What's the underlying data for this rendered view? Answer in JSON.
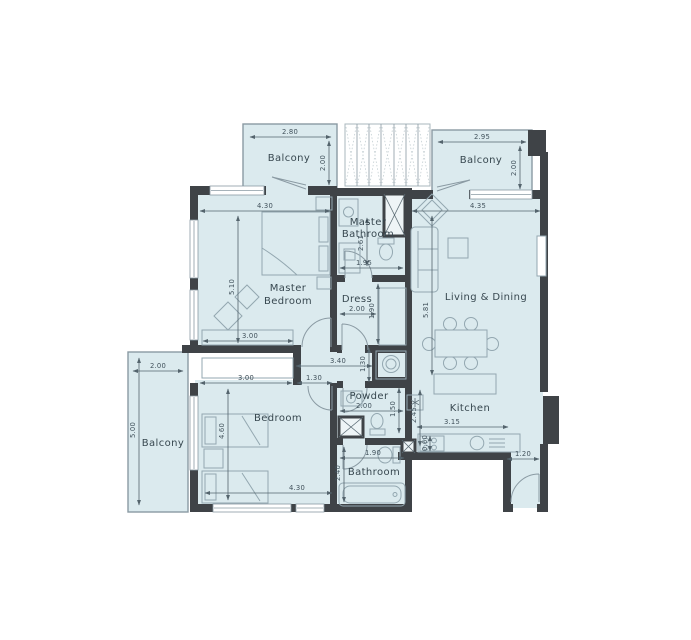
{
  "plan_title": "Apartment Floor Plan",
  "colors": {
    "floor": "#dbeaee",
    "wall": "#3f4347",
    "furniture_line": "#93a7b0",
    "dimension_line": "#54646d",
    "label_text": "#37474f",
    "background": "#ffffff"
  },
  "rooms": {
    "balcony_top_left": {
      "label": "Balcony"
    },
    "balcony_top_right": {
      "label": "Balcony"
    },
    "balcony_left": {
      "label": "Balcony"
    },
    "master_bedroom": {
      "label_line1": "Master",
      "label_line2": "Bedroom"
    },
    "master_bathroom": {
      "label_line1": "Master",
      "label_line2": "Bathroom"
    },
    "dress": {
      "label": "Dress"
    },
    "living_dining": {
      "label": "Living & Dining"
    },
    "bedroom": {
      "label": "Bedroom"
    },
    "powder": {
      "label": "Powder"
    },
    "kitchen": {
      "label": "Kitchen"
    },
    "bathroom": {
      "label": "Bathroom"
    }
  },
  "dimensions": {
    "balcony_top_left_width": "2.80",
    "balcony_top_left_depth": "2.00",
    "balcony_top_right_width": "2.95",
    "balcony_top_right_depth": "2.00",
    "master_bedroom_width": "4.30",
    "master_bedroom_length": "5.10",
    "master_bedroom_wardrobe": "3.00",
    "master_bathroom_width": "1.95",
    "master_bathroom_length": "2.61",
    "dress_width": "2.00",
    "dress_length": "1.90",
    "living_dining_width": "4.35",
    "living_dining_length": "5.81",
    "corridor_length": "3.40",
    "corridor_width": "1.30",
    "bedroom_width": "3.00",
    "bedroom_door": "1.30",
    "bedroom_length": "4.60",
    "bedroom_total_width": "4.30",
    "balcony_left_width": "2.00",
    "balcony_left_length": "5.00",
    "powder_width": "2.00",
    "powder_length": "1.50",
    "bathroom_width": "1.90",
    "bathroom_length": "2.40",
    "kitchen_width": "3.15",
    "kitchen_length": "2.45",
    "kitchen_counter_depth": "0.60",
    "entrance_width": "1.20"
  }
}
